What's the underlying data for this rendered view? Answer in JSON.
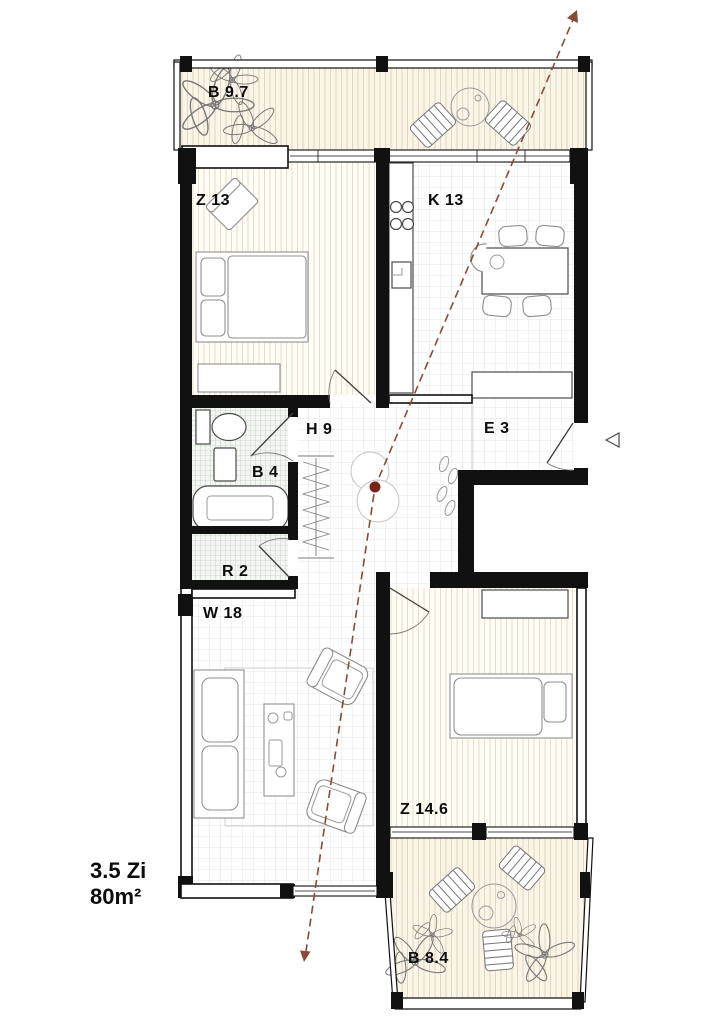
{
  "plan": {
    "summary": {
      "rooms": "3.5 Zi",
      "area": "80m²"
    },
    "rooms": [
      {
        "id": "balcony-top",
        "code": "B 9.7",
        "type": "balcony"
      },
      {
        "id": "bedroom-1",
        "code": "Z 13",
        "type": "bedroom"
      },
      {
        "id": "kitchen",
        "code": "K 13",
        "type": "kitchen"
      },
      {
        "id": "hall",
        "code": "H 9",
        "type": "hall"
      },
      {
        "id": "entrance",
        "code": "E 3",
        "type": "entry"
      },
      {
        "id": "bathroom",
        "code": "B 4",
        "type": "bath"
      },
      {
        "id": "reduit",
        "code": "R 2",
        "type": "storage"
      },
      {
        "id": "living",
        "code": "W 18",
        "type": "living"
      },
      {
        "id": "bedroom-2",
        "code": "Z 14.6",
        "type": "bedroom"
      },
      {
        "id": "balcony-bottom",
        "code": "B 8.4",
        "type": "balcony"
      }
    ],
    "icons": {
      "entrance_marker": "triangle-left",
      "section_path": "dashed-arrow-line"
    },
    "colors": {
      "wall": "#111111",
      "section_line": "#8a4a38",
      "section_dot": "#7a2418",
      "balcony_floor": "#faf5e7",
      "tile_green": "#a9c2a9"
    }
  }
}
